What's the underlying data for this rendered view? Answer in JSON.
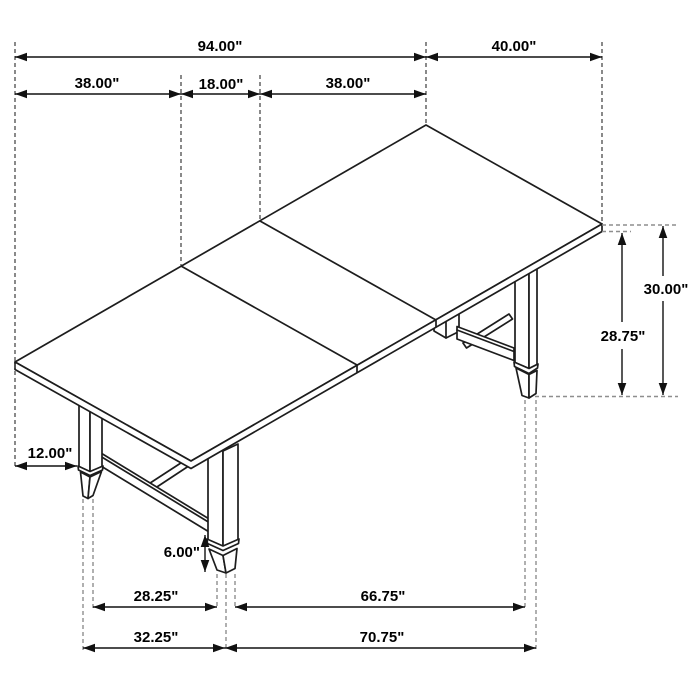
{
  "diagram": {
    "kind": "isometric-furniture-dimension-drawing",
    "subject": "trestle-dining-table-with-extension-leaf"
  },
  "labels": {
    "overall_length": "94.00\"",
    "table_width": "40.00\"",
    "left_section": "38.00\"",
    "center_leaf": "18.00\"",
    "right_section": "38.00\"",
    "table_height": "30.00\"",
    "height_under_top": "28.75\"",
    "leg_inset_from_end": "12.00\"",
    "foot_height": "6.00\"",
    "inner_leg_spacing": "28.25\"",
    "front_leg_spacing": "66.75\"",
    "outer_leg_spacing": "32.25\"",
    "outer_front_leg_spacing": "70.75\""
  },
  "colors": {
    "background": "#ffffff",
    "drawing_line": "#1d1d1d",
    "dimension_line": "#111111",
    "extension_dash_dark": "#4a4a4a",
    "extension_dash_gray": "#8e8e8e",
    "text": "#000000"
  }
}
